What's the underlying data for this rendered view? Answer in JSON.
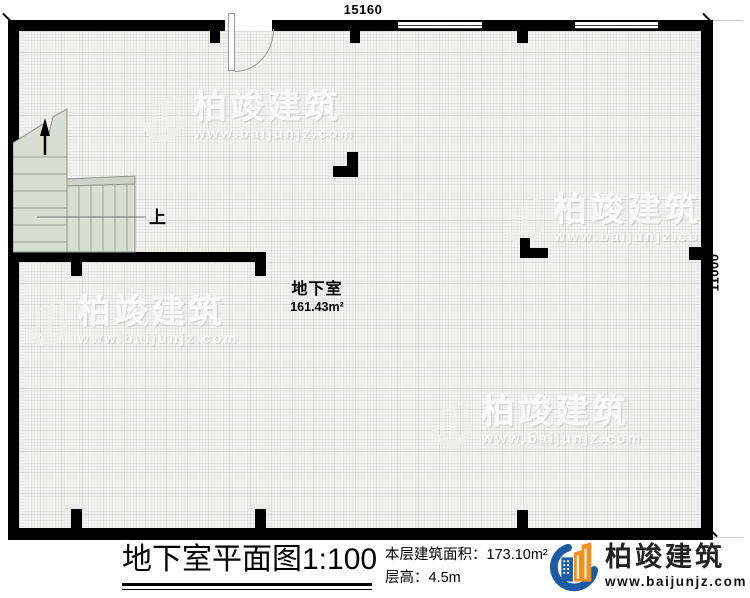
{
  "plan": {
    "dimensions": {
      "top": "15160",
      "right": "11000"
    },
    "room": {
      "name": "地下室",
      "area": "161.43m²"
    },
    "stair": {
      "up_label": "上"
    }
  },
  "watermark": {
    "brand": "柏竣建筑",
    "url": "www.baijunjz.com"
  },
  "titleblock": {
    "title": "地下室平面图",
    "scale": "1:100",
    "area_label": "本层建筑面积：",
    "area_value": "173.10m²",
    "height_label": "层高：",
    "height_value": "4.5m",
    "logo_brand": "柏竣建筑",
    "logo_url": "www.baijunjz.com"
  },
  "colors": {
    "wall": "#000000",
    "floor": "#f2f2f0",
    "stair_fill": "#d9ded5",
    "logo_blue": "#1d5ca5",
    "logo_orange": "#ef9020"
  }
}
